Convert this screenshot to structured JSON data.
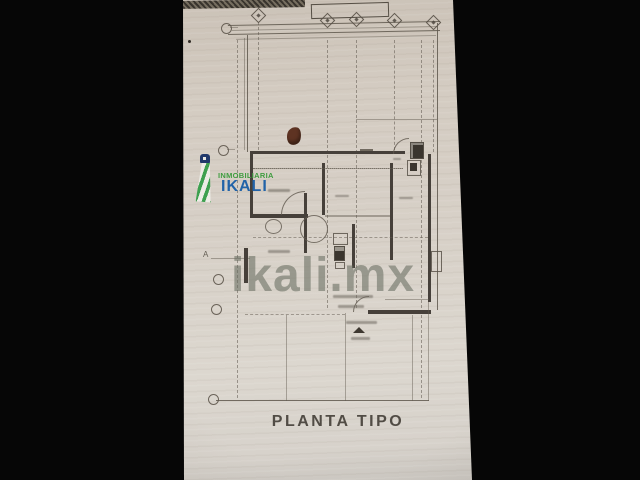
{
  "page": {
    "watermark": "ikali.mx",
    "caption": "PLANTA TIPO"
  },
  "logo": {
    "subtitle": "INMOBILIARIA",
    "title": "IKALI",
    "icon": "lighthouse-icon"
  },
  "floor_plan": {
    "grid_row_label": "A",
    "grid_columns_count": 5,
    "notes": "scanned architectural typical-floor plan; small room labels illegible"
  },
  "colors": {
    "letterbox_black": "#060606",
    "paper_tan": "#d6cfc5",
    "ink_gray": "#5f584e",
    "wall_dark": "#46403a",
    "logo_green": "#3f9c3f",
    "logo_blue": "#2263a8",
    "logo_navy": "#21386b",
    "watermark_gray": "#686c61",
    "stain_brown": "#5e3322",
    "caption_gray": "#514c45"
  }
}
